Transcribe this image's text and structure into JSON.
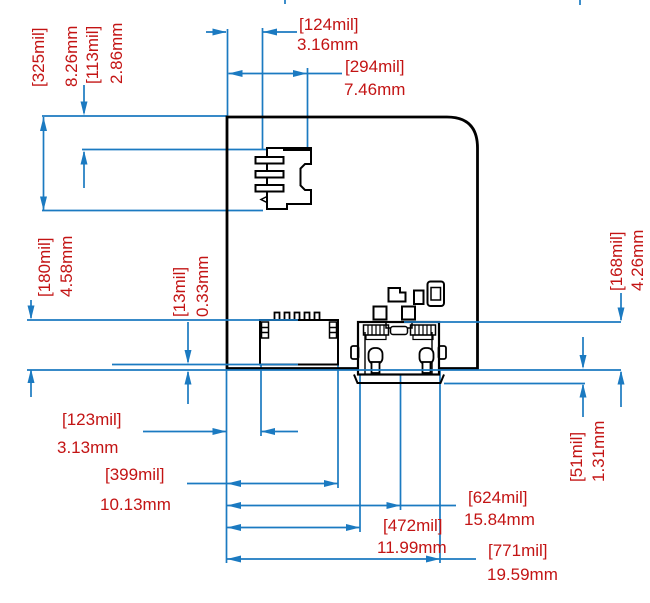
{
  "drawing": {
    "type": "pcb-dimension-drawing",
    "colors": {
      "dimension": "#1b7ac1",
      "text": "#c31414",
      "outline": "#000000",
      "background": "#ffffff"
    },
    "units": {
      "primary": "mil",
      "secondary": "mm"
    },
    "dimensions": {
      "d124": {
        "mil": "[124mil]",
        "mm": "3.16mm"
      },
      "d294": {
        "mil": "[294mil]",
        "mm": "7.46mm"
      },
      "d325": {
        "mil": "[325mil]",
        "mm": "8.26mm"
      },
      "d113": {
        "mil": "[113mil]",
        "mm": "2.86mm"
      },
      "d180": {
        "mil": "[180mil]",
        "mm": "4.58mm"
      },
      "d13": {
        "mil": "[13mil]",
        "mm": "0.33mm"
      },
      "d168": {
        "mil": "[168mil]",
        "mm": "4.26mm"
      },
      "d51": {
        "mil": "[51mil]",
        "mm": "1.31mm"
      },
      "d123": {
        "mil": "[123mil]",
        "mm": "3.13mm"
      },
      "d399": {
        "mil": "[399mil]",
        "mm": "10.13mm"
      },
      "d624": {
        "mil": "[624mil]",
        "mm": "15.84mm"
      },
      "d472": {
        "mil": "[472mil]",
        "mm": "11.99mm"
      },
      "d771": {
        "mil": "[771mil]",
        "mm": "19.59mm"
      }
    },
    "components": {
      "board": "pcb-board-outline",
      "sd": "micro-sd-connector",
      "fpc": "fpc-connector",
      "usb": "micro-usb-connector"
    }
  }
}
